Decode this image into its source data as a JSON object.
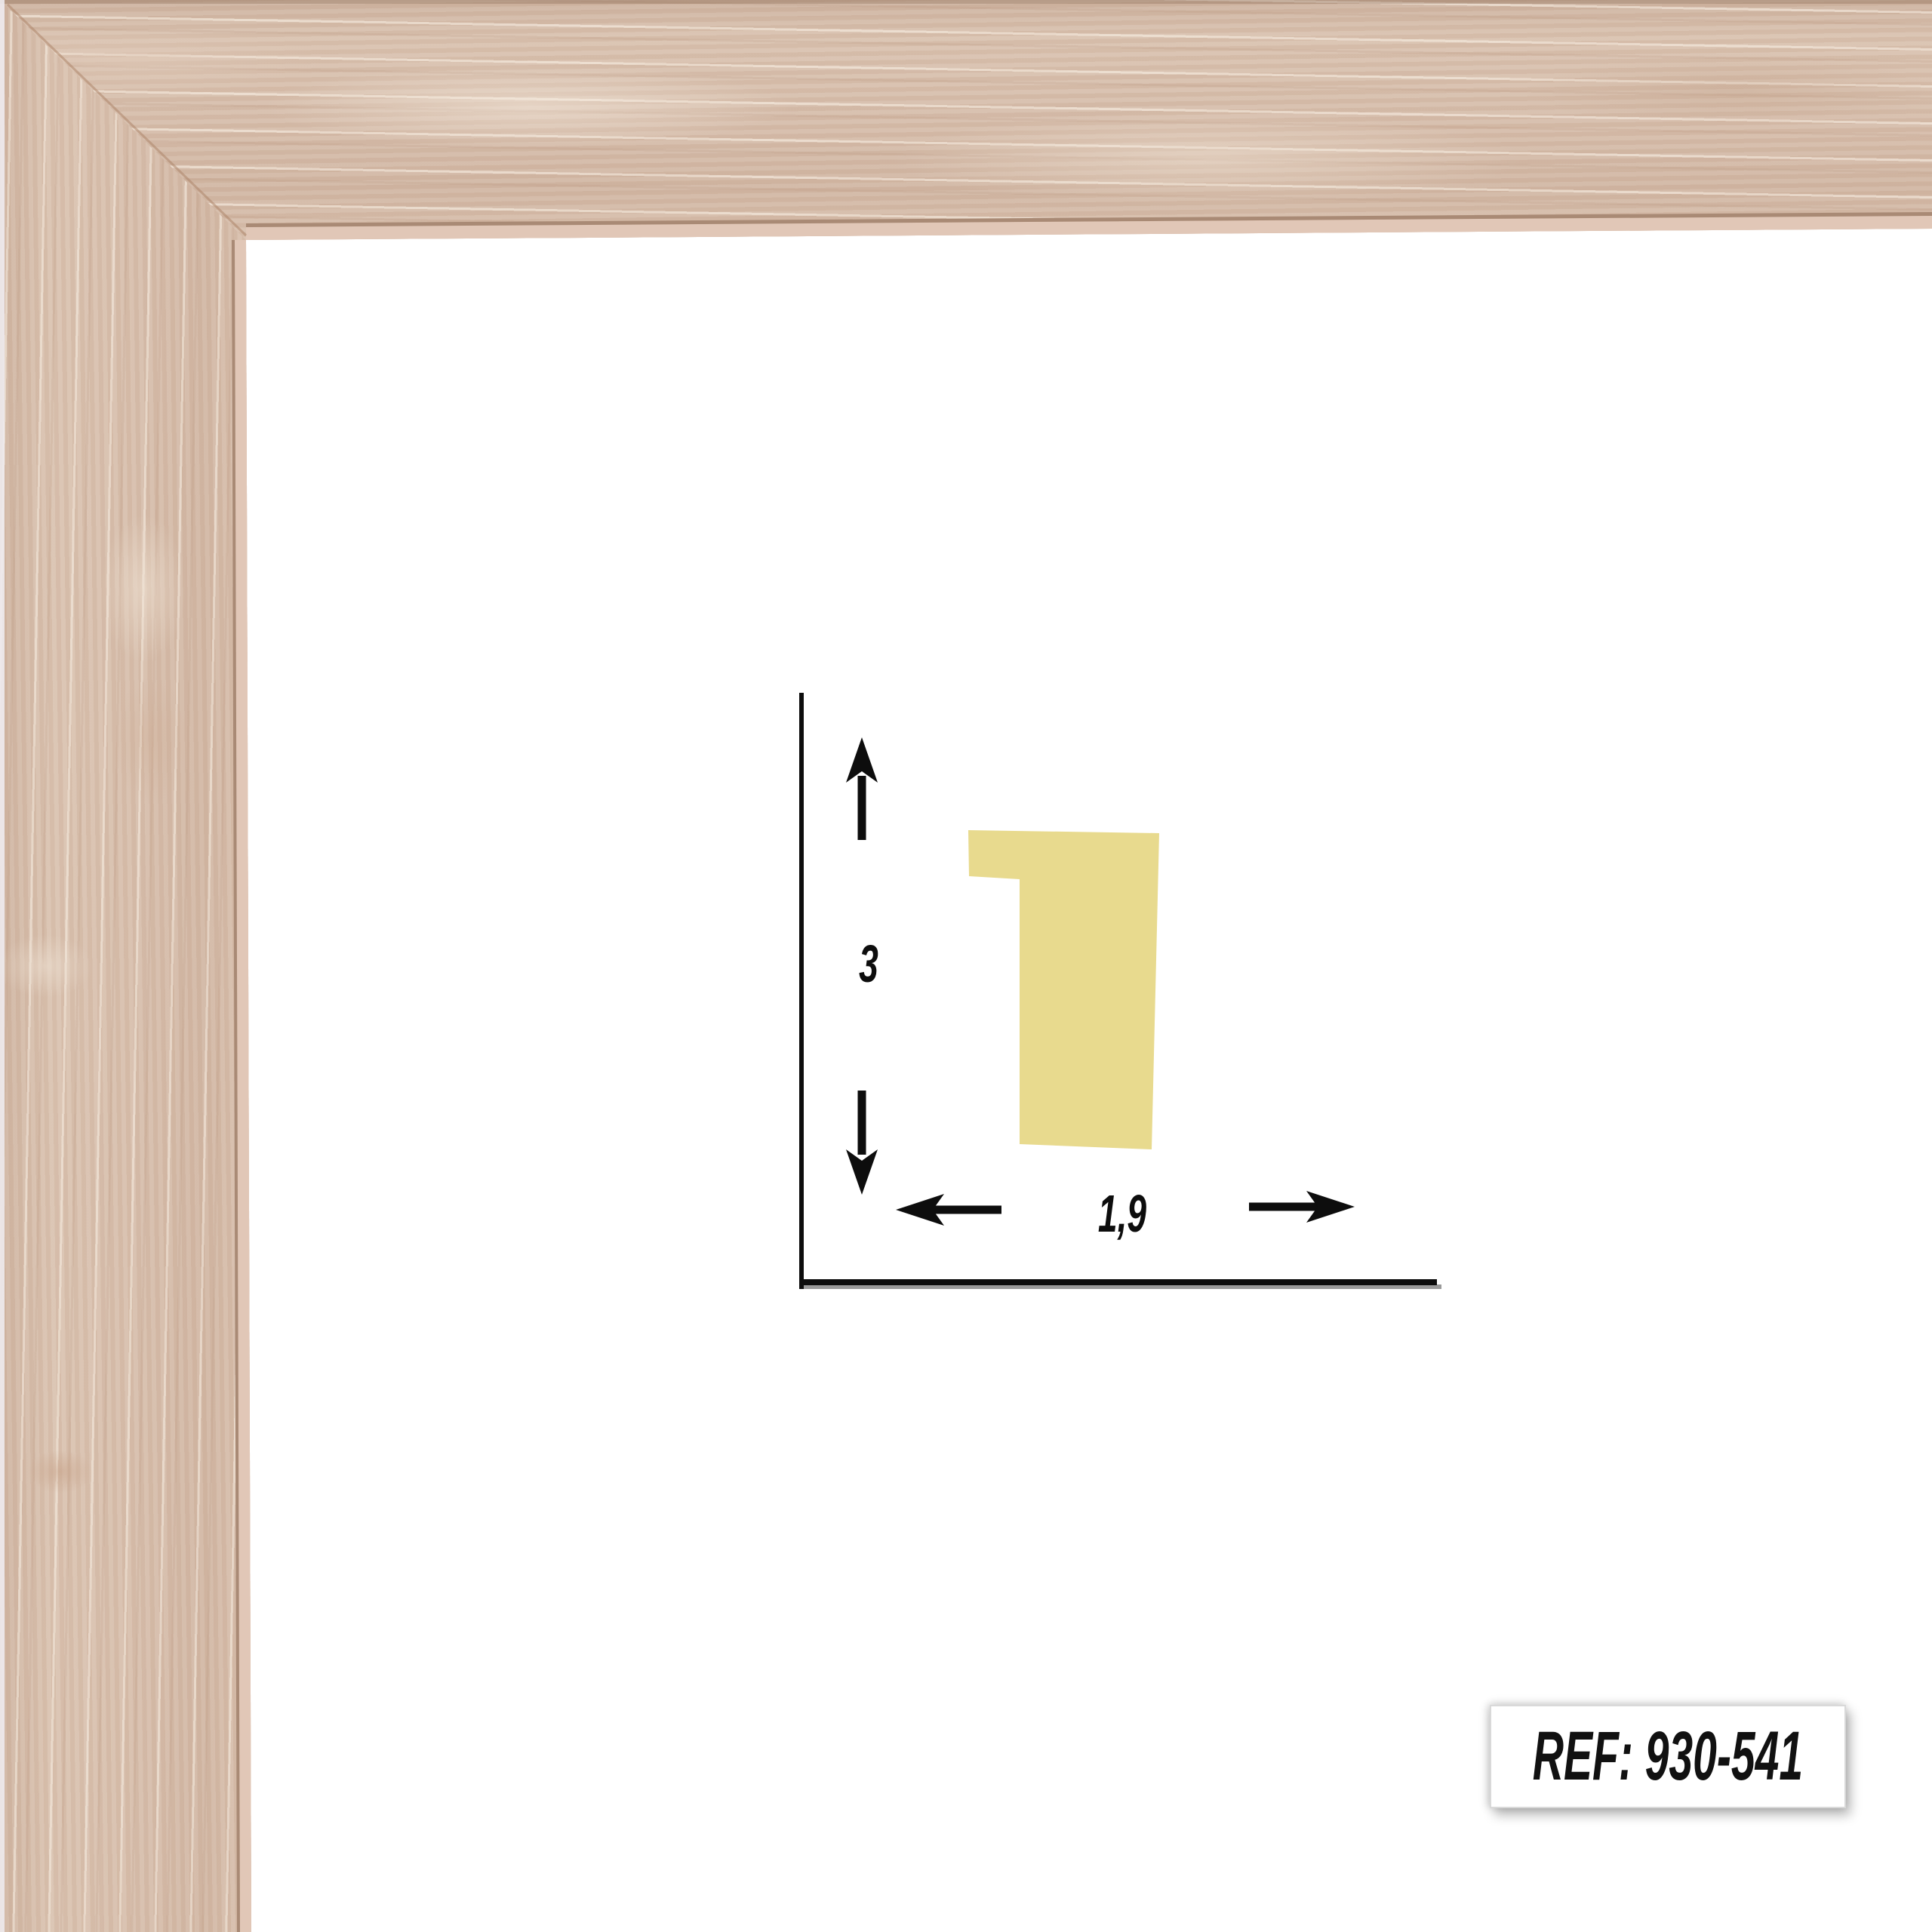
{
  "product_image": {
    "ref_badge": {
      "text": "REF: 930-541"
    },
    "dimension_diagram": {
      "height_label": "3",
      "width_label": "1,9",
      "profile_color": "#e8da8e",
      "line_color": "#0d0d0d",
      "shadow_color": "#9a9a9a"
    },
    "frame_corner": {
      "wood_base_color": "#d2b7a4",
      "wood_highlight_color": "#eadbca",
      "wood_lip_color": "#e1c7b7",
      "wood_seam_color": "#a98a75"
    }
  },
  "icons": {
    "up_arrow": "barbed-arrow-up",
    "down_arrow": "barbed-arrow-down",
    "left_arrow": "barbed-arrow-left",
    "right_arrow": "barbed-arrow-right"
  }
}
